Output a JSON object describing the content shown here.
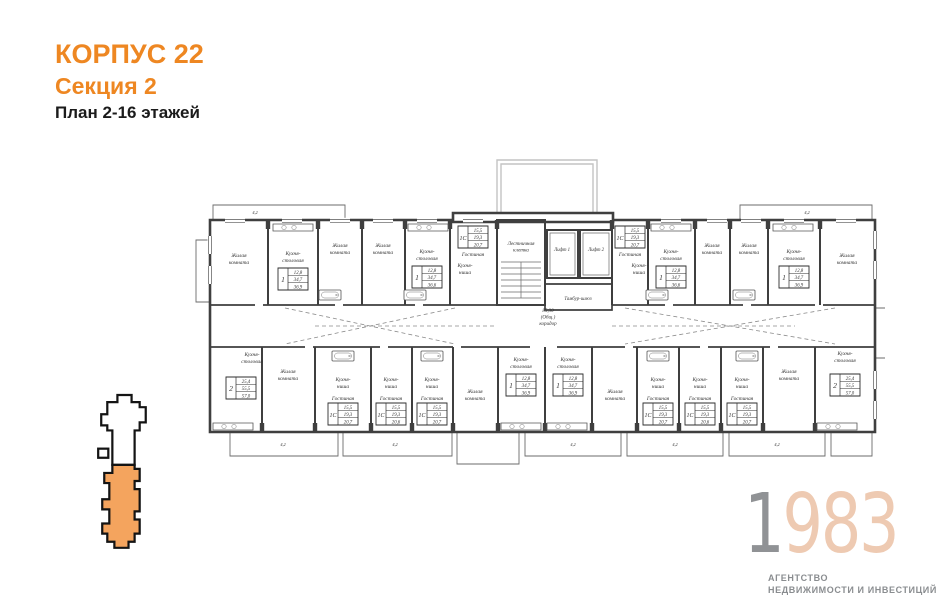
{
  "header": {
    "building": "КОРПУС 22",
    "section": "Секция 2",
    "floors": "План 2-16 этажей"
  },
  "logo": {
    "year_first": "1",
    "year_rest": "983",
    "line1": "АГЕНТСТВО",
    "line2": "НЕДВИЖИМОСТИ И ИНВЕСТИЦИЙ"
  },
  "colors": {
    "accent_orange": "#ee8722",
    "logo_year_first": "#909295",
    "logo_year_rest": "#eecab2",
    "tagline_gray": "#8a8d90",
    "minimap_section_fill": "#f4a45e",
    "plan_line": "#3f3f3f"
  },
  "plan": {
    "corridor": {
      "lines": [
        "85,30",
        "(Общ.)",
        "коридор"
      ],
      "x": 353,
      "y": 167
    },
    "core": {
      "stairs": {
        "lines": [
          "Лестничная",
          "клетка"
        ],
        "x": 326,
        "y": 100
      },
      "lift1": {
        "label": "Лифт 1",
        "x": 367,
        "y": 106
      },
      "lift2": {
        "label": "Лифт 2",
        "x": 401,
        "y": 106
      },
      "vestibule": {
        "label": "Тамбур-шлюз",
        "x": 383,
        "y": 155
      }
    },
    "rooms": [
      {
        "lines": [
          "Жилая",
          "комната"
        ],
        "x": 44,
        "y": 112
      },
      {
        "lines": [
          "Кухня-",
          "столовая"
        ],
        "x": 98,
        "y": 110
      },
      {
        "lines": [
          "Жилая",
          "комната"
        ],
        "x": 145,
        "y": 102
      },
      {
        "lines": [
          "Жилая",
          "комната"
        ],
        "x": 188,
        "y": 102
      },
      {
        "lines": [
          "Кухня-",
          "столовая"
        ],
        "x": 232,
        "y": 108
      },
      {
        "lines": [
          "Гостиная"
        ],
        "x": 278,
        "y": 111
      },
      {
        "lines": [
          "Кухня-",
          "ниша"
        ],
        "x": 270,
        "y": 122
      },
      {
        "lines": [
          "Гостиная"
        ],
        "x": 435,
        "y": 111
      },
      {
        "lines": [
          "Кухня-",
          "ниша"
        ],
        "x": 444,
        "y": 122
      },
      {
        "lines": [
          "Кухня-",
          "столовая"
        ],
        "x": 476,
        "y": 108
      },
      {
        "lines": [
          "Жилая",
          "комната"
        ],
        "x": 517,
        "y": 102
      },
      {
        "lines": [
          "Жилая",
          "комната"
        ],
        "x": 554,
        "y": 102
      },
      {
        "lines": [
          "Кухня-",
          "столовая"
        ],
        "x": 599,
        "y": 108
      },
      {
        "lines": [
          "Жилая",
          "комната"
        ],
        "x": 652,
        "y": 112
      },
      {
        "lines": [
          "Кухня-",
          "столовая"
        ],
        "x": 57,
        "y": 211
      },
      {
        "lines": [
          "Жилая",
          "комната"
        ],
        "x": 93,
        "y": 228
      },
      {
        "lines": [
          "Кухня-",
          "ниша"
        ],
        "x": 148,
        "y": 236
      },
      {
        "lines": [
          "Гостиная"
        ],
        "x": 148,
        "y": 255
      },
      {
        "lines": [
          "Кухня-",
          "ниша"
        ],
        "x": 196,
        "y": 236
      },
      {
        "lines": [
          "Гостиная"
        ],
        "x": 196,
        "y": 255
      },
      {
        "lines": [
          "Кухня-",
          "ниша"
        ],
        "x": 237,
        "y": 236
      },
      {
        "lines": [
          "Гостиная"
        ],
        "x": 237,
        "y": 255
      },
      {
        "lines": [
          "Жилая",
          "комната"
        ],
        "x": 280,
        "y": 248
      },
      {
        "lines": [
          "Кухня-",
          "столовая"
        ],
        "x": 326,
        "y": 216
      },
      {
        "lines": [
          "Кухня-",
          "столовая"
        ],
        "x": 373,
        "y": 216
      },
      {
        "lines": [
          "Жилая",
          "комната"
        ],
        "x": 420,
        "y": 248
      },
      {
        "lines": [
          "Кухня-",
          "ниша"
        ],
        "x": 463,
        "y": 236
      },
      {
        "lines": [
          "Гостиная"
        ],
        "x": 463,
        "y": 255
      },
      {
        "lines": [
          "Кухня-",
          "ниша"
        ],
        "x": 505,
        "y": 236
      },
      {
        "lines": [
          "Гостиная"
        ],
        "x": 505,
        "y": 255
      },
      {
        "lines": [
          "Кухня-",
          "ниша"
        ],
        "x": 547,
        "y": 236
      },
      {
        "lines": [
          "Гостиная"
        ],
        "x": 547,
        "y": 255
      },
      {
        "lines": [
          "Жилая",
          "комната"
        ],
        "x": 594,
        "y": 228
      },
      {
        "lines": [
          "Кухня-",
          "столовая"
        ],
        "x": 650,
        "y": 210
      }
    ],
    "units": [
      {
        "type": "1",
        "areas": [
          "12,8",
          "34,7",
          "36,9"
        ],
        "x": 98,
        "y": 134
      },
      {
        "type": "1",
        "areas": [
          "12,8",
          "34,7",
          "36,6"
        ],
        "x": 232,
        "y": 132
      },
      {
        "type": "1С",
        "areas": [
          "15,5",
          "19,3",
          "20,7"
        ],
        "x": 278,
        "y": 92
      },
      {
        "type": "1С",
        "areas": [
          "15,5",
          "19,3",
          "20,7"
        ],
        "x": 435,
        "y": 92
      },
      {
        "type": "1",
        "areas": [
          "12,8",
          "34,7",
          "36,6"
        ],
        "x": 476,
        "y": 132
      },
      {
        "type": "1",
        "areas": [
          "12,8",
          "34,7",
          "36,9"
        ],
        "x": 599,
        "y": 132
      },
      {
        "type": "2",
        "areas": [
          "25,4",
          "55,5",
          "57,0"
        ],
        "x": 46,
        "y": 243
      },
      {
        "type": "1С",
        "areas": [
          "15,5",
          "19,3",
          "20,7"
        ],
        "x": 148,
        "y": 269
      },
      {
        "type": "1С",
        "areas": [
          "15,5",
          "19,3",
          "20,6"
        ],
        "x": 196,
        "y": 269
      },
      {
        "type": "1С",
        "areas": [
          "15,5",
          "19,3",
          "20,7"
        ],
        "x": 237,
        "y": 269
      },
      {
        "type": "1",
        "areas": [
          "12,8",
          "34,7",
          "36,9"
        ],
        "x": 326,
        "y": 240
      },
      {
        "type": "1",
        "areas": [
          "12,8",
          "34,7",
          "36,9"
        ],
        "x": 373,
        "y": 240
      },
      {
        "type": "1С",
        "areas": [
          "15,5",
          "19,3",
          "20,7"
        ],
        "x": 463,
        "y": 269
      },
      {
        "type": "1С",
        "areas": [
          "15,5",
          "19,3",
          "20,6"
        ],
        "x": 505,
        "y": 269
      },
      {
        "type": "1С",
        "areas": [
          "15,5",
          "19,3",
          "20,7"
        ],
        "x": 547,
        "y": 269
      },
      {
        "type": "2",
        "areas": [
          "25,4",
          "55,5",
          "57,0"
        ],
        "x": 650,
        "y": 240
      }
    ],
    "balcony_dims": [
      {
        "label": "4,2",
        "x": 88,
        "y": 301
      },
      {
        "label": "4,2",
        "x": 200,
        "y": 301
      },
      {
        "label": "4,2",
        "x": 378,
        "y": 301
      },
      {
        "label": "4,2",
        "x": 480,
        "y": 301
      },
      {
        "label": "4,2",
        "x": 582,
        "y": 301
      },
      {
        "label": "4,2",
        "x": 60,
        "y": 69
      },
      {
        "label": "4,2",
        "x": 612,
        "y": 69
      }
    ]
  }
}
